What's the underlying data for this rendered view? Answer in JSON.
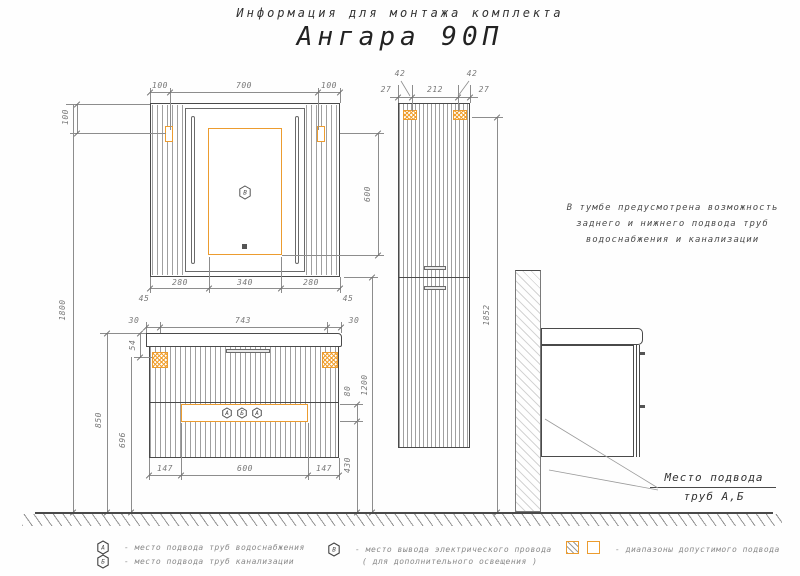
{
  "title": {
    "subtitle": "Информация для монтажа комплекта",
    "model": "Ангара 90П"
  },
  "note": {
    "line1": "В тумбе предусмотрена возможность",
    "line2": "заднего и нижнего подвода труб",
    "line3": "водоснабжения и канализации"
  },
  "pipe_location_label": {
    "line1": "Место подвода",
    "line2": "труб А,Б"
  },
  "legend": {
    "water": {
      "symbol": "А",
      "text": "-  место подвода труб водоснабжения"
    },
    "sewer": {
      "symbol": "Б",
      "text": "-  место подвода труб канализации"
    },
    "electric": {
      "symbol": "В",
      "text": "-  место вывода электрического провода",
      "text2": "( для дополнительного освещения )"
    },
    "ranges": {
      "text": "-  диапазоны допустимого подвода"
    }
  },
  "symbols": {
    "mirror_outlet": "В",
    "strip": [
      "А",
      "Б",
      "А"
    ]
  },
  "colors": {
    "accent_orange": "#ec9c2f",
    "line_gray": "#8d8d8d",
    "outline_dark": "#4a4a4a"
  },
  "dims": {
    "overall_height": "1800",
    "mirror": {
      "top": [
        "100",
        "700",
        "100"
      ],
      "left": "100",
      "right": "600",
      "bottom": [
        "280",
        "340",
        "280"
      ],
      "corners": [
        "45",
        "45"
      ]
    },
    "vanity": {
      "top": [
        "30",
        "743",
        "30"
      ],
      "left": [
        "54",
        "850",
        "696"
      ],
      "right": [
        "1200",
        "80",
        "430"
      ],
      "bottom": [
        "147",
        "600",
        "147"
      ]
    },
    "tall": {
      "top": [
        "42",
        "27",
        "212",
        "27",
        "42"
      ],
      "height": "1852"
    }
  }
}
